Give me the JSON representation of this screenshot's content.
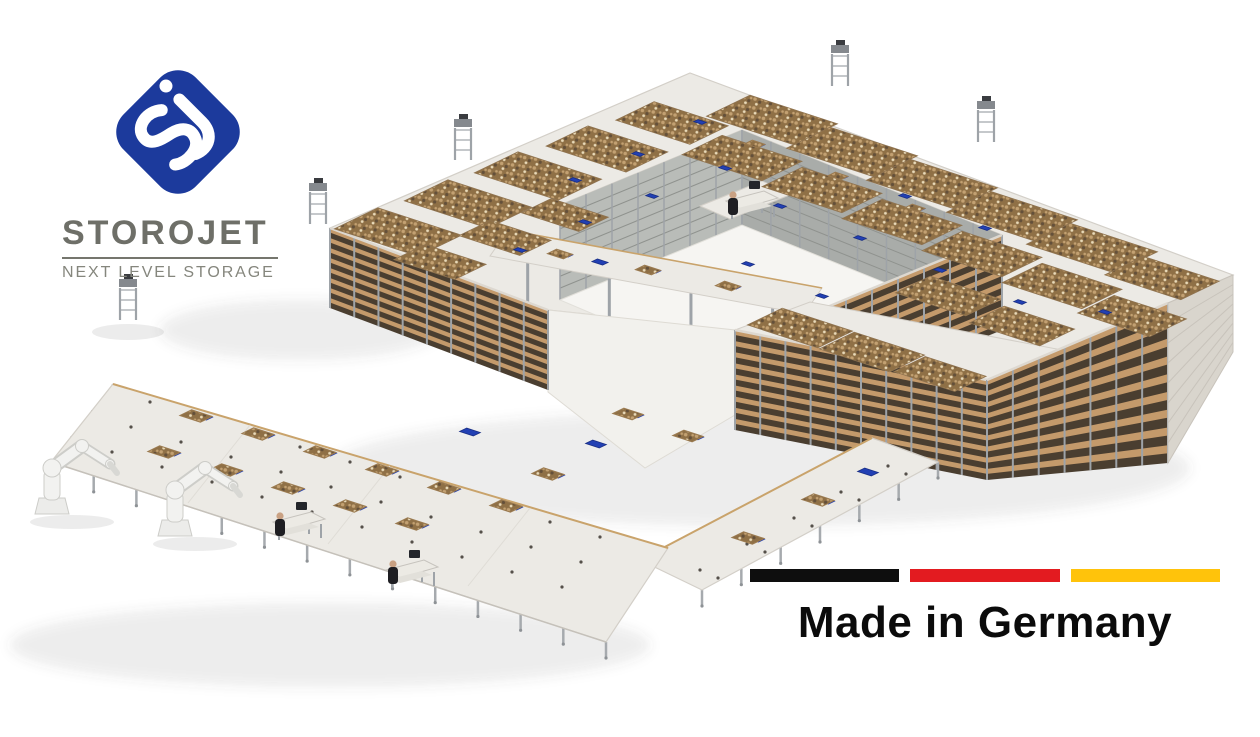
{
  "branding": {
    "title": "STOROJET",
    "subtitle": "NEXT LEVEL STORAGE",
    "logo_color": "#1C3A9C",
    "monogram": "sj",
    "title_color": "#6E6F68",
    "underline_color": "#75766D",
    "subtitle_color": "#85867D"
  },
  "badge": {
    "label": "Made in Germany",
    "text_color": "#0B0B0B",
    "flag_colors": [
      "#0E0E0E",
      "#E31B20",
      "#FFC30B"
    ]
  },
  "scene": {
    "colors": {
      "deck": "#ECEAE5",
      "deck_edge": "#D3CFC8",
      "trim": "#C9A36B",
      "floor": "#F6F5F2",
      "apron": "#F2F1ED",
      "shelf_tan": "#C49A6B",
      "shelf_dark": "#4A3E30",
      "post": "#9EA3A8",
      "inner_wall": "#B9BCB8",
      "inner_wall2": "#A9ACA9",
      "wall_stripe": "#8F928E",
      "box_base": "#8F7046",
      "box_light": "#C3A172",
      "box_dark": "#64503A",
      "box_pale": "#E9DAB9",
      "robot_blue": "#2240B4",
      "tray_edge": "#9A7A50",
      "arm_white": "#F2F2F0",
      "arm_edge": "#CDCDC9",
      "person_dark": "#1E1E22",
      "skin": "#C9A183",
      "shadow": "rgba(70,70,70,0.10)"
    },
    "structure": {
      "deck_outline": [
        [
          330,
          228
        ],
        [
          690,
          73
        ],
        [
          1233,
          275
        ],
        [
          1168,
          303
        ],
        [
          987,
          380
        ],
        [
          735,
          330
        ],
        [
          548,
          310
        ]
      ],
      "hole": [
        [
          560,
          205
        ],
        [
          742,
          130
        ],
        [
          1002,
          235
        ],
        [
          820,
          310
        ]
      ],
      "inner_wall_left": [
        [
          560,
          205
        ],
        [
          742,
          130
        ],
        [
          742,
          225
        ],
        [
          560,
          300
        ]
      ],
      "inner_wall_back": [
        [
          742,
          130
        ],
        [
          1002,
          235
        ],
        [
          1002,
          330
        ],
        [
          742,
          225
        ]
      ],
      "courtyard_floor": [
        [
          560,
          300
        ],
        [
          742,
          225
        ],
        [
          1002,
          330
        ],
        [
          820,
          410
        ]
      ],
      "block_top": [
        [
          735,
          330
        ],
        [
          987,
          380
        ],
        [
          1062,
          350
        ],
        [
          810,
          302
        ]
      ],
      "right_face": [
        [
          1168,
          303
        ],
        [
          1233,
          275
        ],
        [
          1233,
          352
        ],
        [
          1168,
          463
        ]
      ],
      "apron": [
        [
          548,
          310
        ],
        [
          735,
          330
        ],
        [
          735,
          415
        ],
        [
          645,
          468
        ],
        [
          548,
          392
        ]
      ],
      "faces": [
        {
          "a": [
            820,
            310
          ],
          "b": [
            1002,
            235
          ],
          "h": 95,
          "levels": 8
        },
        {
          "a": [
            735,
            330
          ],
          "b": [
            987,
            380
          ],
          "h": 100,
          "levels": 9
        },
        {
          "a": [
            330,
            228
          ],
          "b": [
            548,
            310
          ],
          "h": 80,
          "levels": 8
        },
        {
          "a": [
            987,
            380
          ],
          "b": [
            1168,
            303
          ],
          "h": 100,
          "h2": 160,
          "levels": 9
        }
      ],
      "bridge": [
        [
          508,
          230
        ],
        [
          822,
          288
        ],
        [
          804,
          314
        ],
        [
          490,
          256
        ]
      ],
      "bridge_posts": [
        0.12,
        0.38,
        0.64,
        0.9
      ],
      "bridge_spur": [
        [
          700,
          206
        ],
        [
          762,
          181
        ],
        [
          792,
          194
        ],
        [
          730,
          219
        ]
      ]
    },
    "box_fields": [
      [
        398,
        232,
        88,
        50
      ],
      [
        468,
        204,
        88,
        50
      ],
      [
        538,
        176,
        88,
        50
      ],
      [
        607,
        149,
        84,
        48
      ],
      [
        672,
        123,
        78,
        44
      ],
      [
        440,
        262,
        64,
        36
      ],
      [
        505,
        238,
        64,
        36
      ],
      [
        565,
        215,
        60,
        34
      ],
      [
        772,
        120,
        92,
        50
      ],
      [
        852,
        152,
        92,
        50
      ],
      [
        932,
        184,
        92,
        50
      ],
      [
        1012,
        216,
        92,
        50
      ],
      [
        1092,
        248,
        92,
        50
      ],
      [
        1162,
        278,
        80,
        44
      ],
      [
        742,
        158,
        84,
        46
      ],
      [
        822,
        190,
        84,
        46
      ],
      [
        902,
        222,
        84,
        46
      ],
      [
        982,
        254,
        84,
        46
      ],
      [
        1062,
        286,
        84,
        46
      ],
      [
        1132,
        316,
        76,
        42
      ],
      [
        948,
        296,
        74,
        40
      ],
      [
        1022,
        326,
        74,
        40
      ],
      [
        800,
        328,
        74,
        40
      ],
      [
        872,
        352,
        74,
        40
      ],
      [
        940,
        374,
        64,
        36
      ]
    ],
    "deck_robots": [
      [
        520,
        250,
        0
      ],
      [
        585,
        222,
        0
      ],
      [
        652,
        196,
        0
      ],
      [
        725,
        168,
        0
      ],
      [
        700,
        122,
        0
      ],
      [
        780,
        206,
        0
      ],
      [
        860,
        238,
        0
      ],
      [
        940,
        270,
        0
      ],
      [
        1020,
        302,
        0
      ],
      [
        905,
        196,
        0
      ],
      [
        985,
        228,
        0
      ],
      [
        748,
        264,
        0
      ],
      [
        822,
        296,
        0
      ],
      [
        1105,
        312,
        0
      ],
      [
        638,
        154,
        0
      ],
      [
        575,
        180,
        0
      ],
      [
        755,
        144,
        1
      ],
      [
        838,
        176,
        1
      ],
      [
        915,
        208,
        1
      ]
    ],
    "bridge_robots": [
      [
        560,
        254,
        1
      ],
      [
        648,
        270,
        1
      ],
      [
        728,
        286,
        1
      ],
      [
        600,
        262,
        0
      ]
    ],
    "courtyard_robots": [
      [
        622,
        352,
        1
      ],
      [
        688,
        376,
        1
      ],
      [
        748,
        396,
        1
      ],
      [
        580,
        324,
        0
      ]
    ],
    "apron_robots": [
      [
        628,
        414,
        1
      ],
      [
        688,
        436,
        1
      ]
    ],
    "courtyard_stations": [
      [
        560,
        335
      ],
      [
        600,
        370
      ]
    ],
    "bridge_station": [
      748,
      201
    ],
    "towers": [
      [
        840,
        86
      ],
      [
        986,
        142
      ],
      [
        463,
        160
      ],
      [
        318,
        224
      ],
      [
        128,
        320
      ]
    ],
    "platform": {
      "top": [
        [
          113,
          384
        ],
        [
          668,
          548
        ],
        [
          606,
          642
        ],
        [
          51,
          462
        ]
      ],
      "walkway": [
        [
          640,
          560
        ],
        [
          872,
          438
        ],
        [
          938,
          462
        ],
        [
          702,
          590
        ]
      ],
      "robots": [
        [
          196,
          416,
          1
        ],
        [
          258,
          434,
          1
        ],
        [
          320,
          452,
          1
        ],
        [
          382,
          470,
          1
        ],
        [
          444,
          488,
          1
        ],
        [
          506,
          506,
          1
        ],
        [
          164,
          452,
          1
        ],
        [
          226,
          470,
          1
        ],
        [
          288,
          488,
          1
        ],
        [
          350,
          506,
          1
        ],
        [
          412,
          524,
          1
        ],
        [
          548,
          474,
          1
        ],
        [
          596,
          444,
          0
        ],
        [
          470,
          432,
          0
        ],
        [
          748,
          538,
          1
        ],
        [
          818,
          500,
          1
        ],
        [
          868,
          472,
          0
        ]
      ],
      "stations": [
        [
          295,
          522
        ],
        [
          408,
          570
        ]
      ],
      "arms": [
        [
          52,
          498
        ],
        [
          175,
          520
        ]
      ]
    }
  }
}
